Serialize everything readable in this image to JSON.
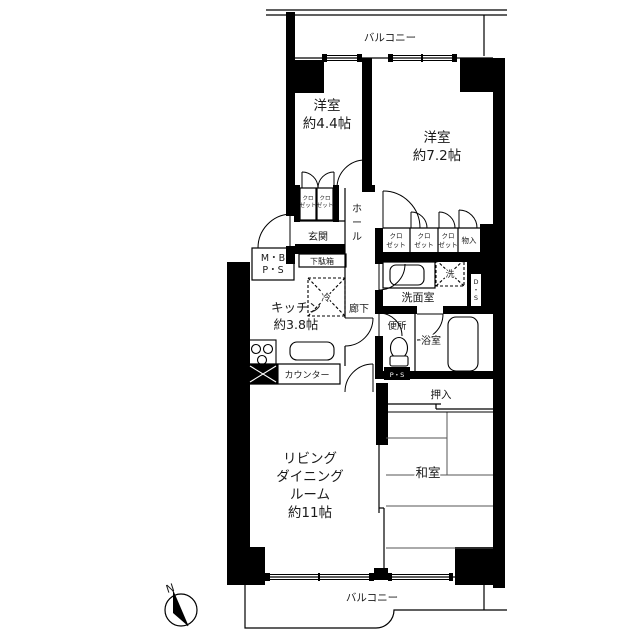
{
  "plan": {
    "balcony_top": "バルコニー",
    "balcony_bottom": "バルコニー",
    "bedroom1": {
      "name": "洋室",
      "size": "約4.4帖"
    },
    "bedroom2": {
      "name": "洋室",
      "size": "約7.2帖"
    },
    "kitchen": {
      "name": "キッチン",
      "size": "約3.8帖"
    },
    "living": {
      "line1": "リビング",
      "line2": "ダイニング",
      "line3": "ルーム",
      "line4": "約11帖"
    },
    "japanese_room": "和室",
    "entrance": "玄関",
    "hall": {
      "c1": "ホ",
      "c2": "ー",
      "c3": "ル"
    },
    "shoe_cabinet": "下駄箱",
    "meter_box": {
      "line1": "M・B",
      "line2": "P・S"
    },
    "closet": {
      "line1": "クロ",
      "line2": "ゼット"
    },
    "storage": "物入",
    "washroom": "洗面室",
    "washer": "洗",
    "duct_space": {
      "c1": "D",
      "c2": "・",
      "c3": "S"
    },
    "fridge": "冷",
    "corridor": "廊下",
    "toilet": "便所",
    "pipe_space": "P・S",
    "bathroom": "浴室",
    "counter": "カウンター",
    "futon_closet": "押入",
    "compass_north": "N",
    "colors": {
      "wall": "#000000",
      "background": "#ffffff"
    }
  }
}
